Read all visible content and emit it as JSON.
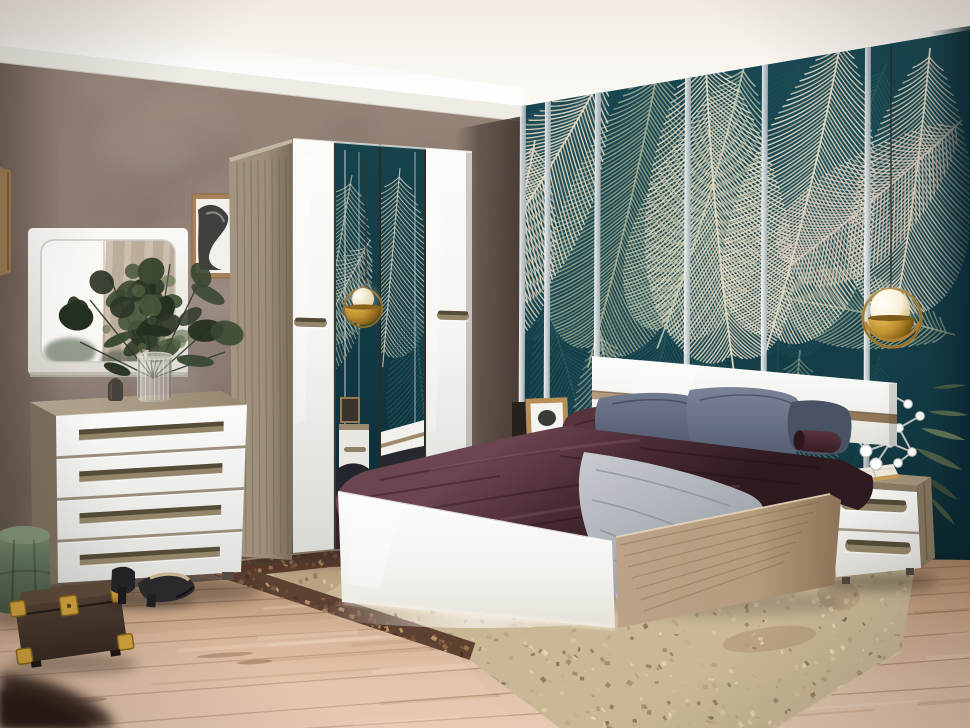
{
  "scene": {
    "type": "photograph",
    "subject": "modern bedroom furniture set against tropical palm-leaf wallpaper",
    "objects": [
      "cove-lit-ceiling",
      "taupe-plaster-wall",
      "palm-wallpaper-panels",
      "chrome-seam-strips",
      "wall-mirror",
      "framed-art",
      "four-door-wardrobe-with-mirror-doors",
      "chest-of-drawers",
      "vase-with-eucalyptus",
      "candle-lantern",
      "double-bed",
      "gloss-headboard",
      "plum-duvet",
      "gray-pillows",
      "knit-throw",
      "nightstand",
      "open-book",
      "molecule-decor",
      "potted-plant-leaves",
      "brass-pendant-lamp-left",
      "brass-pendant-lamp-right",
      "vintage-area-rug",
      "light-wood-floor",
      "green-velvet-pouf",
      "vintage-travel-case",
      "black-high-heels"
    ]
  },
  "colors": {
    "ceiling": "#f2ebe4",
    "ceiling_glow": "#fffefb",
    "molding": "#efece6",
    "wall": "#8b7a70",
    "wall_light": "#968478",
    "wall_dark": "#6e5f55",
    "wall_corner": "#564941",
    "teal": "#1a4953",
    "teal_dark": "#0e333d",
    "teal_corner": "#0a2831",
    "frond_cream": "#e7dac3",
    "frond_blush": "#e2cdbd",
    "frond_sage": "#a9b195",
    "frond_pale": "#cdd1b6",
    "frond_teal": "#2b5d66",
    "frond_deep": "#1e4e58",
    "chrome": "#eef1f2",
    "chrome_edge": "#97a1a6",
    "gloss": "#f5f5f2",
    "gloss_shade": "#dcdcd8",
    "wood": "#9c8d79",
    "wood_dark": "#7b6c5a",
    "wood_light": "#b4a68f",
    "oak": "#b49c7e",
    "oak_dark": "#8d765a",
    "handle": "#93866a",
    "handle_slot": "#49422f",
    "plum": "#503138",
    "plum_light": "#6e4a52",
    "plum_dark": "#2f1a20",
    "gray_pillow": "#5c6578",
    "gray_pillow_light": "#79829a",
    "gray_pillow_dark": "#434b5e",
    "throw": "#bcc0c6",
    "throw_dark": "#8f949c",
    "rug": "#c9b795",
    "rug_border": "#5d4131",
    "floor": "#c5a183",
    "floor_light": "#e0c2a8",
    "floor_dark": "#96714f",
    "pouf": "#5e7159",
    "pouf_light": "#7b8d71",
    "pouf_dark": "#45533f",
    "case_brown": "#46372c",
    "case_top": "#5d4a39",
    "brass": "#c2932f",
    "brass_dark": "#7e5c18",
    "globe": "#fff8e8",
    "shoe": "#26262a",
    "insole": "#c9b492",
    "leaf": "#3c4a35",
    "leaf_light": "#5c6e4e",
    "book_pages": "#efeade",
    "book_cover": "#c8a05c",
    "frame_wood": "#a8825a"
  }
}
